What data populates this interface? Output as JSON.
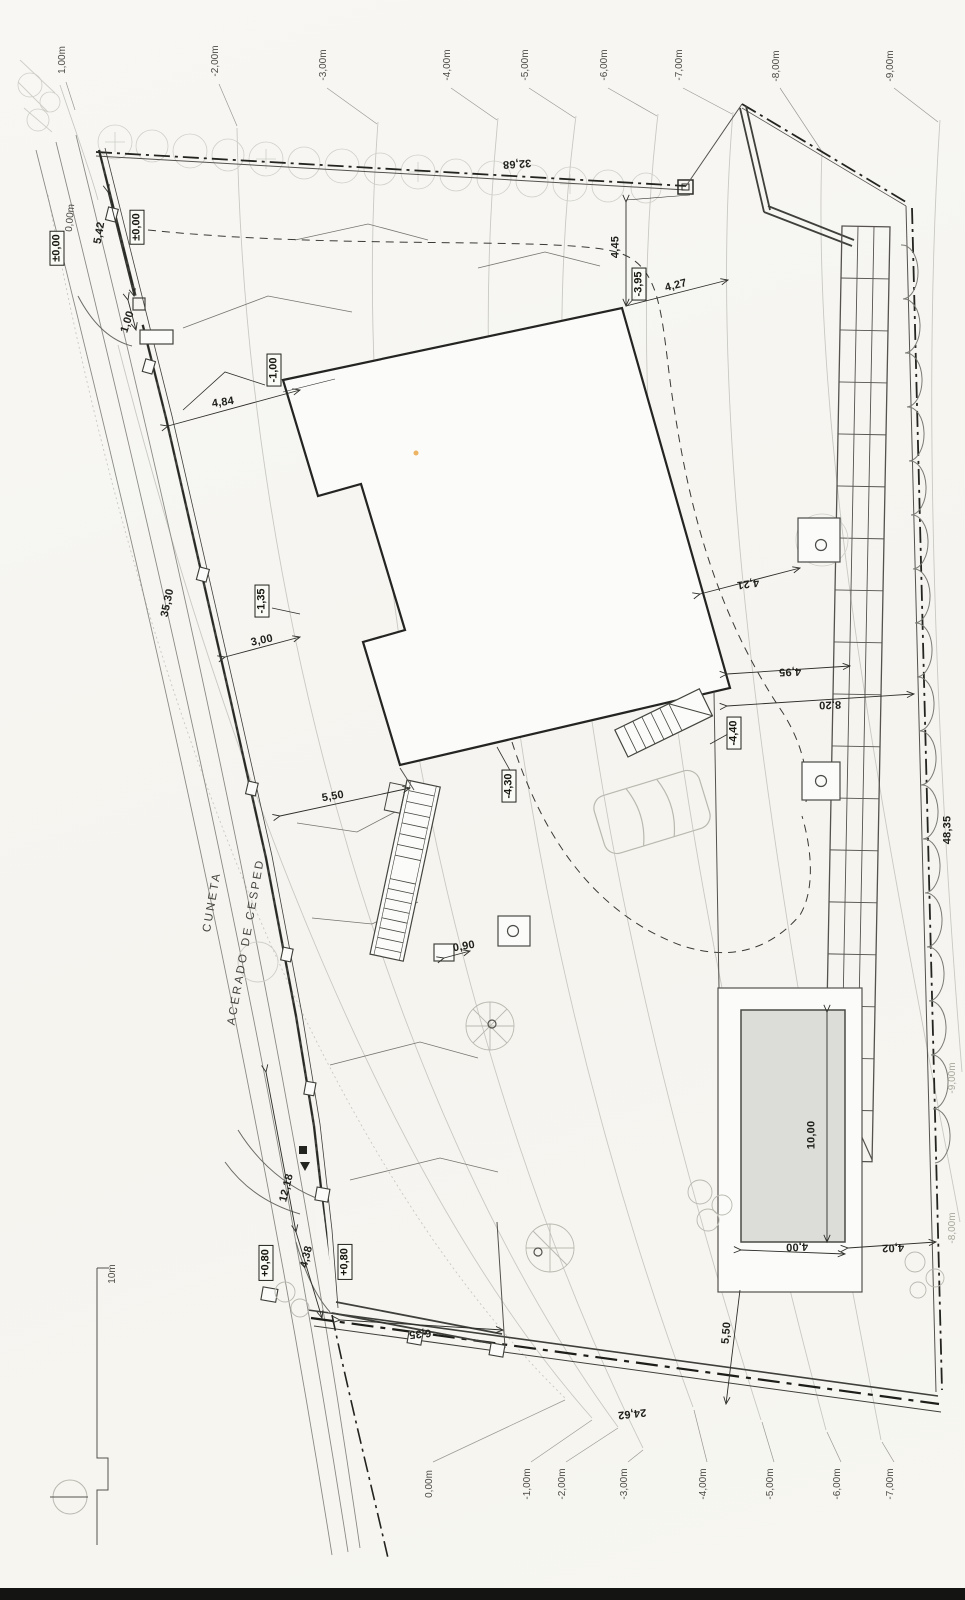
{
  "document": {
    "kind": "scanned architectural site plan",
    "street_labels": [
      "CUNETA",
      "ACERADO DE CESPED"
    ],
    "scale_reference": "10m"
  },
  "colors": {
    "paper": "#f7f6f2",
    "ink": "#23231f",
    "contour_line": "#c9c9c3",
    "pool_water": "#dcdcd8",
    "faint_sketch": "#b9b9b0",
    "scan_artifact": "#e8a33d",
    "page_edge": "#141412"
  },
  "elevation_boxes": [
    "±0,00",
    "±0,00",
    "-1,00",
    "-1,35",
    "-3,95",
    "-4,30",
    "-4,40",
    "+0,80",
    "+0,80"
  ],
  "dimensions": [
    "5,42",
    "1,00",
    "4,84",
    "35,30",
    "3,00",
    "5,50",
    "4,45",
    "4,27",
    "4,21",
    "4,95",
    "8,20",
    "0,90",
    "32,68",
    "48,35",
    "12,18",
    "4,38",
    "6,35",
    "24,62",
    "5,50",
    "10,00",
    "4,00",
    "4,02"
  ],
  "contour_labels_top": [
    "1,00m",
    "-2,00m",
    "-3,00m",
    "-4,00m",
    "-5,00m",
    "-6,00m",
    "-7,00m",
    "-8,00m",
    "-9,00m"
  ],
  "contour_labels_bottom": [
    "0,00m",
    "-1,00m",
    "-2,00m",
    "-3,00m",
    "-4,00m",
    "-5,00m",
    "-6,00m",
    "-7,00m"
  ],
  "contour_labels_right": [
    "-9,00m",
    "-8,00m"
  ],
  "labels": [
    {
      "n": "contour-label-plus1",
      "t": "1,00m",
      "x": 63,
      "y": 60,
      "r": -90,
      "c": "contour"
    },
    {
      "n": "contour-label-m2-top",
      "t": "-2,00m",
      "x": 216,
      "y": 61,
      "r": -90,
      "c": "contour"
    },
    {
      "n": "contour-label-m3-top",
      "t": "-3,00m",
      "x": 324,
      "y": 65,
      "r": -90,
      "c": "contour"
    },
    {
      "n": "contour-label-m4-top",
      "t": "-4,00m",
      "x": 448,
      "y": 65,
      "r": -90,
      "c": "contour"
    },
    {
      "n": "contour-label-m5-top",
      "t": "-5,00m",
      "x": 526,
      "y": 65,
      "r": -90,
      "c": "contour"
    },
    {
      "n": "contour-label-m6-top",
      "t": "-6,00m",
      "x": 605,
      "y": 65,
      "r": -90,
      "c": "contour"
    },
    {
      "n": "contour-label-m7-top",
      "t": "-7,00m",
      "x": 680,
      "y": 65,
      "r": -90,
      "c": "contour"
    },
    {
      "n": "contour-label-m8-top",
      "t": "-8,00m",
      "x": 777,
      "y": 66,
      "r": -90,
      "c": "contour"
    },
    {
      "n": "contour-label-m9-top",
      "t": "-9,00m",
      "x": 891,
      "y": 66,
      "r": -90,
      "c": "contour"
    },
    {
      "n": "level-box-street",
      "t": "±0,00",
      "x": 57,
      "y": 248,
      "r": -90,
      "c": "box"
    },
    {
      "n": "contour-label-0-street",
      "t": "0,00m",
      "x": 71,
      "y": 218,
      "r": -85,
      "c": "contour"
    },
    {
      "n": "dim-5-42",
      "t": "5,42",
      "x": 100,
      "y": 233,
      "r": -80,
      "c": "dim"
    },
    {
      "n": "level-box-entry",
      "t": "±0,00",
      "x": 137,
      "y": 227,
      "r": -90,
      "c": "box"
    },
    {
      "n": "dim-1-00",
      "t": "1,00",
      "x": 128,
      "y": 322,
      "r": -72,
      "c": "dim"
    },
    {
      "n": "level-box-minus1",
      "t": "-1,00",
      "x": 274,
      "y": 370,
      "r": -90,
      "c": "box"
    },
    {
      "n": "dim-4-84",
      "t": "4,84",
      "x": 223,
      "y": 403,
      "r": -8,
      "c": "dim"
    },
    {
      "n": "dim-35-30",
      "t": "35,30",
      "x": 168,
      "y": 603,
      "r": -78,
      "c": "dim"
    },
    {
      "n": "level-box-minus1-35",
      "t": "-1,35",
      "x": 262,
      "y": 601,
      "r": -90,
      "c": "box"
    },
    {
      "n": "dim-3-00",
      "t": "3,00",
      "x": 262,
      "y": 641,
      "r": -12,
      "c": "dim"
    },
    {
      "n": "dim-5-50-upper",
      "t": "5,50",
      "x": 333,
      "y": 797,
      "r": -10,
      "c": "dim"
    },
    {
      "n": "dim-4-45",
      "t": "4,45",
      "x": 616,
      "y": 247,
      "r": -90,
      "c": "dim"
    },
    {
      "n": "level-box-minus3-95",
      "t": "-3,95",
      "x": 639,
      "y": 284,
      "r": -90,
      "c": "box"
    },
    {
      "n": "dim-4-27",
      "t": "4,27",
      "x": 676,
      "y": 286,
      "r": -14,
      "c": "dim"
    },
    {
      "n": "dim-32-68",
      "t": "32,68",
      "x": 517,
      "y": 163,
      "r": 176,
      "c": "dim"
    },
    {
      "n": "level-box-minus4-30",
      "t": "-4,30",
      "x": 509,
      "y": 786,
      "r": -90,
      "c": "box"
    },
    {
      "n": "level-box-minus4-40",
      "t": "-4,40",
      "x": 734,
      "y": 733,
      "r": -90,
      "c": "box"
    },
    {
      "n": "dim-4-21",
      "t": "4,21",
      "x": 748,
      "y": 583,
      "r": 172,
      "c": "dim"
    },
    {
      "n": "dim-4-95",
      "t": "4,95",
      "x": 790,
      "y": 671,
      "r": 178,
      "c": "dim"
    },
    {
      "n": "dim-8-20",
      "t": "8,20",
      "x": 830,
      "y": 704,
      "r": 178,
      "c": "dim"
    },
    {
      "n": "dim-48-35",
      "t": "48,35",
      "x": 948,
      "y": 830,
      "r": -90,
      "c": "dim"
    },
    {
      "n": "dim-0-90",
      "t": "0,90",
      "x": 464,
      "y": 947,
      "r": -10,
      "c": "dim"
    },
    {
      "n": "street-label-cuneta",
      "t": "CUNETA",
      "x": 213,
      "y": 902,
      "r": -80,
      "c": "street"
    },
    {
      "n": "street-label-acerado",
      "t": "ACERADO DE CESPED",
      "x": 247,
      "y": 942,
      "r": -80,
      "c": "street"
    },
    {
      "n": "dim-12-18",
      "t": "12,18",
      "x": 287,
      "y": 1188,
      "r": -76,
      "c": "dim"
    },
    {
      "n": "dim-4-38",
      "t": "4,38",
      "x": 307,
      "y": 1257,
      "r": -76,
      "c": "dim"
    },
    {
      "n": "level-box-plus0-80-a",
      "t": "+0,80",
      "x": 266,
      "y": 1263,
      "r": -90,
      "c": "box"
    },
    {
      "n": "level-box-plus0-80-b",
      "t": "+0,80",
      "x": 345,
      "y": 1262,
      "r": -90,
      "c": "box"
    },
    {
      "n": "dim-6-35",
      "t": "6,35",
      "x": 420,
      "y": 1333,
      "r": 174,
      "c": "dim"
    },
    {
      "n": "dim-24-62",
      "t": "24,62",
      "x": 632,
      "y": 1413,
      "r": 174,
      "c": "dim"
    },
    {
      "n": "dim-5-50-lower",
      "t": "5,50",
      "x": 727,
      "y": 1333,
      "r": -85,
      "c": "dim"
    },
    {
      "n": "dim-10-00-pool",
      "t": "10,00",
      "x": 812,
      "y": 1135,
      "r": -90,
      "c": "dim"
    },
    {
      "n": "dim-4-00-pool",
      "t": "4,00",
      "x": 797,
      "y": 1246,
      "r": 178,
      "c": "dim"
    },
    {
      "n": "dim-4-02",
      "t": "4,02",
      "x": 893,
      "y": 1247,
      "r": 178,
      "c": "dim"
    },
    {
      "n": "scale-label-10m",
      "t": "10m",
      "x": 113,
      "y": 1274,
      "r": -90,
      "c": "contour"
    },
    {
      "n": "contour-label-0-bottom",
      "t": "0,00m",
      "x": 430,
      "y": 1484,
      "r": -90,
      "c": "contour"
    },
    {
      "n": "contour-label-m1-bottom",
      "t": "-1,00m",
      "x": 528,
      "y": 1484,
      "r": -90,
      "c": "contour"
    },
    {
      "n": "contour-label-m2-bottom",
      "t": "-2,00m",
      "x": 563,
      "y": 1484,
      "r": -90,
      "c": "contour"
    },
    {
      "n": "contour-label-m3-bottom",
      "t": "-3,00m",
      "x": 625,
      "y": 1484,
      "r": -90,
      "c": "contour"
    },
    {
      "n": "contour-label-m4-bottom",
      "t": "-4,00m",
      "x": 704,
      "y": 1484,
      "r": -90,
      "c": "contour"
    },
    {
      "n": "contour-label-m5-bottom",
      "t": "-5,00m",
      "x": 771,
      "y": 1484,
      "r": -90,
      "c": "contour"
    },
    {
      "n": "contour-label-m6-bottom",
      "t": "-6,00m",
      "x": 838,
      "y": 1484,
      "r": -90,
      "c": "contour"
    },
    {
      "n": "contour-label-m7-bottom",
      "t": "-7,00m",
      "x": 891,
      "y": 1484,
      "r": -90,
      "c": "contour"
    },
    {
      "n": "contour-label-m9-right",
      "t": "-9,00m",
      "x": 953,
      "y": 1078,
      "r": -90,
      "c": "faint"
    },
    {
      "n": "contour-label-m8-right",
      "t": "-8,00m",
      "x": 953,
      "y": 1228,
      "r": -90,
      "c": "faint"
    }
  ]
}
